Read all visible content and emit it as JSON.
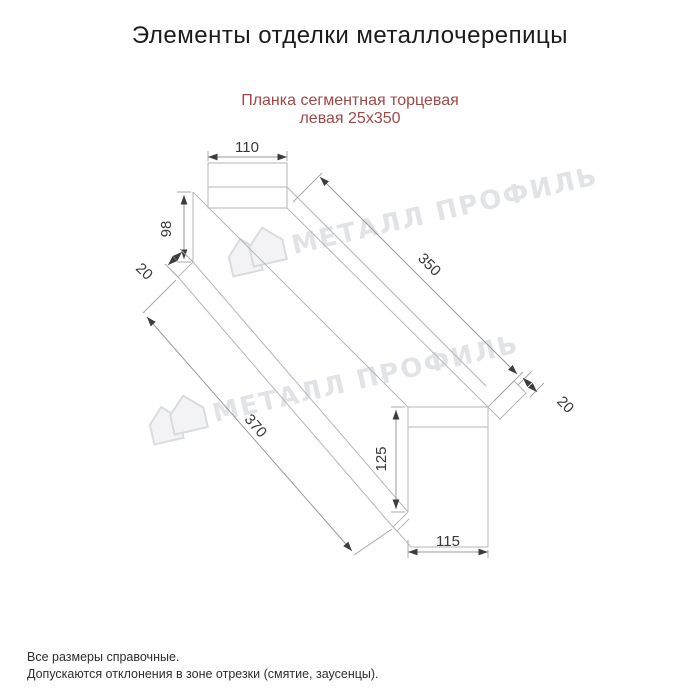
{
  "title": "Элементы отделки металлочерепицы",
  "subtitle": {
    "line1": "Планка сегментная торцевая",
    "line2": "левая 25х350",
    "color": "#a04848"
  },
  "watermark": {
    "text": "МЕТАЛЛ ПРОФИЛЬ",
    "color": "#dcdfe3"
  },
  "dims": {
    "top_width": "110",
    "left_height": "98",
    "left_flap": "20",
    "top_length": "350",
    "bottom_length": "370",
    "right_flap": "20",
    "right_height": "125",
    "bottom_width": "115"
  },
  "footnotes": {
    "line1": "Все размеры справочные.",
    "line2": "Допускаются отклонения в зоне отрезки (смятие, заусенцы)."
  },
  "colors": {
    "drawing_line": "#b6b6b6",
    "dimension_line": "#9a9a9a",
    "text": "#383838"
  }
}
